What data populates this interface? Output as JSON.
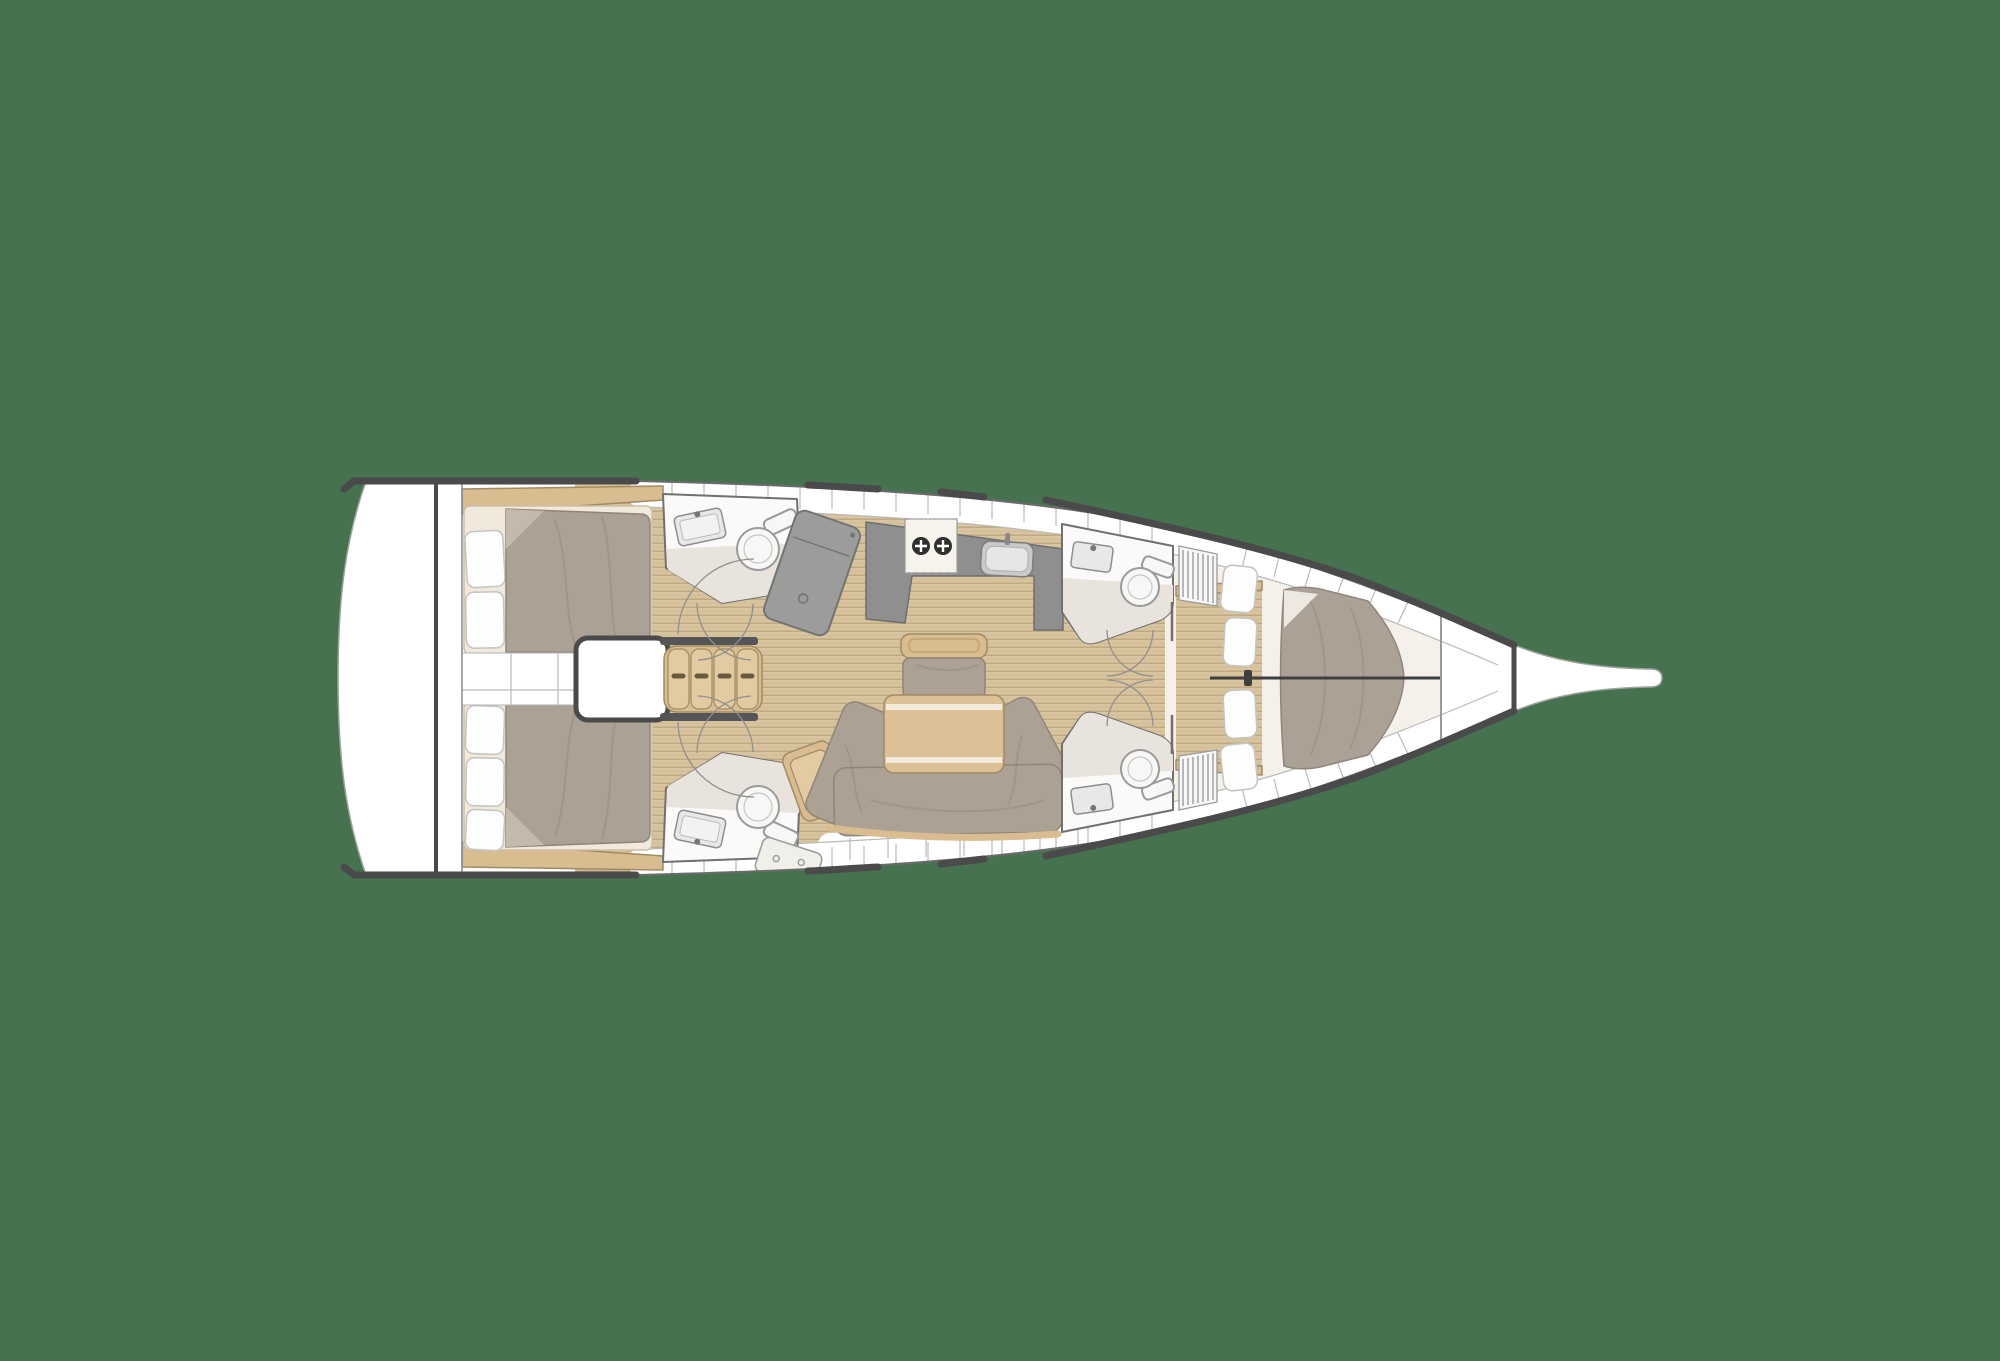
{
  "meta": {
    "title": "Sailing yacht interior layout plan — overhead view",
    "diagram_type": "boat-floor-plan",
    "visible_text": ""
  },
  "colors": {
    "background": "#46724F",
    "hull": "#FFFFFF",
    "hull_outline": "#9BA29A",
    "deck_line": "#4A4A4A",
    "wood_floor": "#D8C49E",
    "wood_plank": "#BCA67D",
    "wood_furniture": "#D9BC90",
    "upholstery": "#ABA194",
    "mattress": "#F1E9DB",
    "platform": "#F5F1EA",
    "pillow": "#FDFDFD",
    "counter": "#8F8F8F",
    "shower_unit": "#9C9C9B",
    "head_floor": "#E8E3DC",
    "head_wall": "#FBFAF8",
    "locker_line": "#B9B9B9",
    "burner": "#2F2F2F",
    "stove": "#F6F3EC"
  },
  "regions": [
    {
      "id": "swim-platform",
      "label": "Transom / swim platform"
    },
    {
      "id": "aft-cabin-port",
      "label": "Aft double cabin (port)"
    },
    {
      "id": "aft-cabin-starboard",
      "label": "Aft double cabin (starboard)"
    },
    {
      "id": "companionway-stairs",
      "label": "Companionway steps"
    },
    {
      "id": "engine-compartment",
      "label": "Engine box under companionway"
    },
    {
      "id": "head-aft-port",
      "label": "Aft head with shower unit (port)"
    },
    {
      "id": "head-aft-starboard",
      "label": "Aft head with shower tray (starboard)"
    },
    {
      "id": "nav-seat",
      "label": "Chart/nav seat"
    },
    {
      "id": "galley",
      "label": "Galley with 2-burner stove and sink"
    },
    {
      "id": "saloon",
      "label": "Saloon with U-shaped sofa, table and bench"
    },
    {
      "id": "head-forward-port",
      "label": "Forward ensuite head (port)"
    },
    {
      "id": "head-forward-starboard",
      "label": "Forward ensuite head (starboard)"
    },
    {
      "id": "hanging-lockers",
      "label": "Slatted hanging lockers"
    },
    {
      "id": "forward-cabin",
      "label": "Forward owner cabin with V-berth"
    },
    {
      "id": "anchor-locker",
      "label": "Anchor locker"
    },
    {
      "id": "bowsprit",
      "label": "Bowsprit"
    }
  ],
  "fixture_counts": {
    "toilets": 4,
    "bathroom_sinks": 4,
    "galley_sinks": 1,
    "stove_burners": 2,
    "double_berths": 3,
    "pillows": 9,
    "companionway_treads": 4
  }
}
